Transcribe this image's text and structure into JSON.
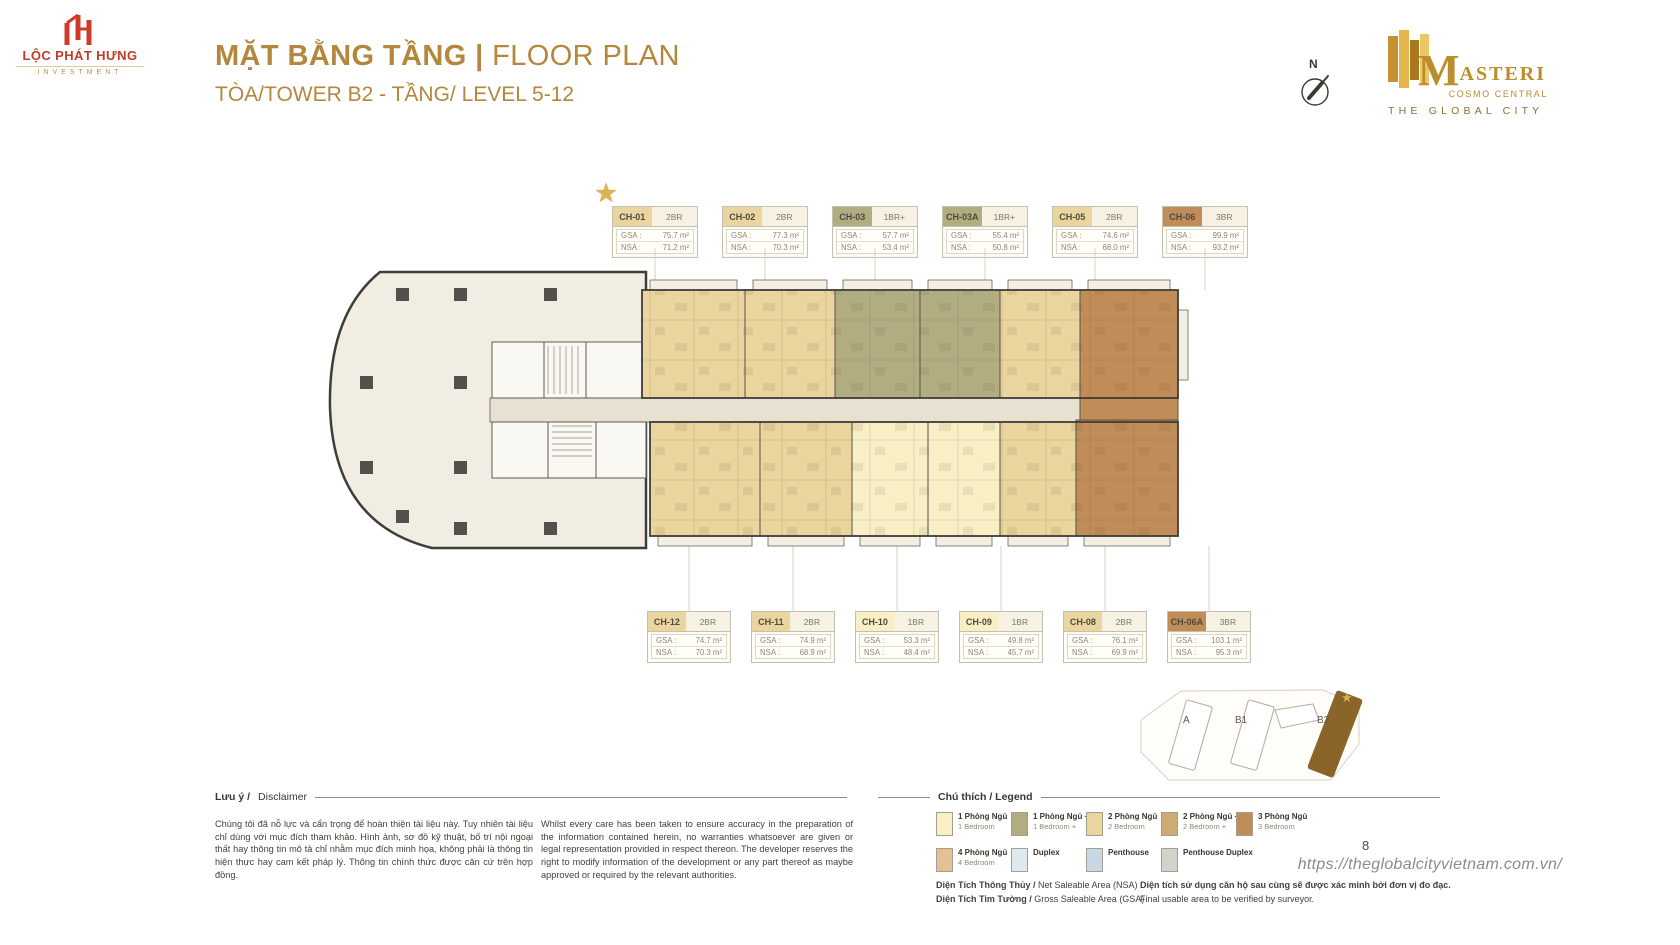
{
  "page": {
    "number": "8",
    "url": "https://theglobalcityvietnam.com.vn/"
  },
  "icons": {
    "star": "★"
  },
  "branding": {
    "developer": {
      "line1": "LỘC PHÁT HƯNG",
      "line2": "INVESTMENT"
    },
    "project": {
      "initial": "M",
      "rest": "ASTERI",
      "sub": "COSMO CENTRAL",
      "tagline": "THE GLOBAL CITY"
    }
  },
  "header": {
    "title_vi": "MẶT BẰNG TẦNG",
    "separator": " | ",
    "title_en": "FLOOR PLAN",
    "subtitle": "TÒA/TOWER B2 - TẦNG/ LEVEL 5-12",
    "compass": "N"
  },
  "labels": {
    "gsa": "GSA :",
    "nsa": "NSA :"
  },
  "colors": {
    "bedroom1": "#f8efc5",
    "bedroom1p": "#b2ad80",
    "bedroom2": "#ebd59e",
    "bedroom2p": "#cdab75",
    "bedroom3": "#c08c57",
    "bedroom4": "#e4c193",
    "duplex": "#dfe9ed",
    "penthouse": "#c6d9e2",
    "penthouse_duplex": "#d2d2cc"
  },
  "units_top": [
    {
      "code": "CH-01",
      "type": "2BR",
      "gsa": "75.7 m²",
      "nsa": "71.2 m²",
      "color": "#ebd59e"
    },
    {
      "code": "CH-02",
      "type": "2BR",
      "gsa": "77.3 m²",
      "nsa": "70.3 m²",
      "color": "#ebd59e"
    },
    {
      "code": "CH-03",
      "type": "1BR+",
      "gsa": "57.7 m²",
      "nsa": "53.4 m²",
      "color": "#b2ad80"
    },
    {
      "code": "CH-03A",
      "type": "1BR+",
      "gsa": "55.4 m²",
      "nsa": "50.8 m²",
      "color": "#b2ad80"
    },
    {
      "code": "CH-05",
      "type": "2BR",
      "gsa": "74.6 m²",
      "nsa": "68.0 m²",
      "color": "#ebd59e"
    },
    {
      "code": "CH-06",
      "type": "3BR",
      "gsa": "99.9 m²",
      "nsa": "93.2 m²",
      "color": "#c08c57"
    }
  ],
  "units_bottom": [
    {
      "code": "CH-12",
      "type": "2BR",
      "gsa": "74.7 m²",
      "nsa": "70.3 m²",
      "color": "#ebd59e"
    },
    {
      "code": "CH-11",
      "type": "2BR",
      "gsa": "74.9 m²",
      "nsa": "68.9 m²",
      "color": "#ebd59e"
    },
    {
      "code": "CH-10",
      "type": "1BR",
      "gsa": "53.3 m²",
      "nsa": "48.4 m²",
      "color": "#f8efc5"
    },
    {
      "code": "CH-09",
      "type": "1BR",
      "gsa": "49.8 m²",
      "nsa": "45.7 m²",
      "color": "#f8efc5"
    },
    {
      "code": "CH-08",
      "type": "2BR",
      "gsa": "76.1 m²",
      "nsa": "69.9 m²",
      "color": "#ebd59e"
    },
    {
      "code": "CH-06A",
      "type": "3BR",
      "gsa": "103.1 m²",
      "nsa": "95.3 m²",
      "color": "#c08c57"
    }
  ],
  "legend": {
    "title": "Chú thích / Legend",
    "items": [
      {
        "vi": "1 Phòng Ngủ",
        "en": "1 Bedroom"
      },
      {
        "vi": "1 Phòng Ngủ +",
        "en": "1 Bedroom +"
      },
      {
        "vi": "2 Phòng Ngủ",
        "en": "2 Bedroom"
      },
      {
        "vi": "2 Phòng Ngủ +",
        "en": "2 Bedroom +"
      },
      {
        "vi": "3 Phòng Ngủ",
        "en": "3 Bedroom"
      },
      {
        "vi": "4 Phòng Ngủ",
        "en": "4 Bedroom"
      },
      {
        "vi": "Duplex",
        "en": ""
      },
      {
        "vi": "Penthouse",
        "en": ""
      },
      {
        "vi": "Penthouse Duplex",
        "en": ""
      }
    ]
  },
  "disclaimer": {
    "title_vi": "Lưu ý /",
    "title_en": "Disclaimer",
    "body_vi": "Chúng tôi đã nỗ lực và cẩn trọng để hoàn thiện tài liệu này. Tuy nhiên tài liệu chỉ dùng với mục đích tham khảo. Hình ảnh, sơ đồ kỹ thuật, bố trí nội ngoại thất hay thông tin mô tả chỉ nhằm mục đích minh họa, không phải là thông tin hiện thực hay cam kết pháp lý. Thông tin chính thức được căn cứ trên hợp đồng.",
    "body_en": "Whilst every care has been taken to ensure accuracy in the preparation of the information contained herein, no warranties whatsoever are given or legal representation provided in respect thereon. The developer reserves the right to modify information of the development or any part thereof as maybe approved or required by the relevant authorities."
  },
  "area_notes": {
    "nsa_vi": "Diện Tích Thông Thủy /",
    "nsa_en": " Net Saleable Area (NSA)",
    "gsa_vi": "Diện Tích Tim Tường /",
    "gsa_en": " Gross Saleable Area (GSA)",
    "note_vi": "Diện tích sử dụng căn hộ sau cùng sẽ được xác minh bởi đơn vị đo đạc.",
    "note_en": "Final usable area to be verified by surveyor."
  },
  "minimap": {
    "towers": [
      "A",
      "B1",
      "B2"
    ]
  }
}
